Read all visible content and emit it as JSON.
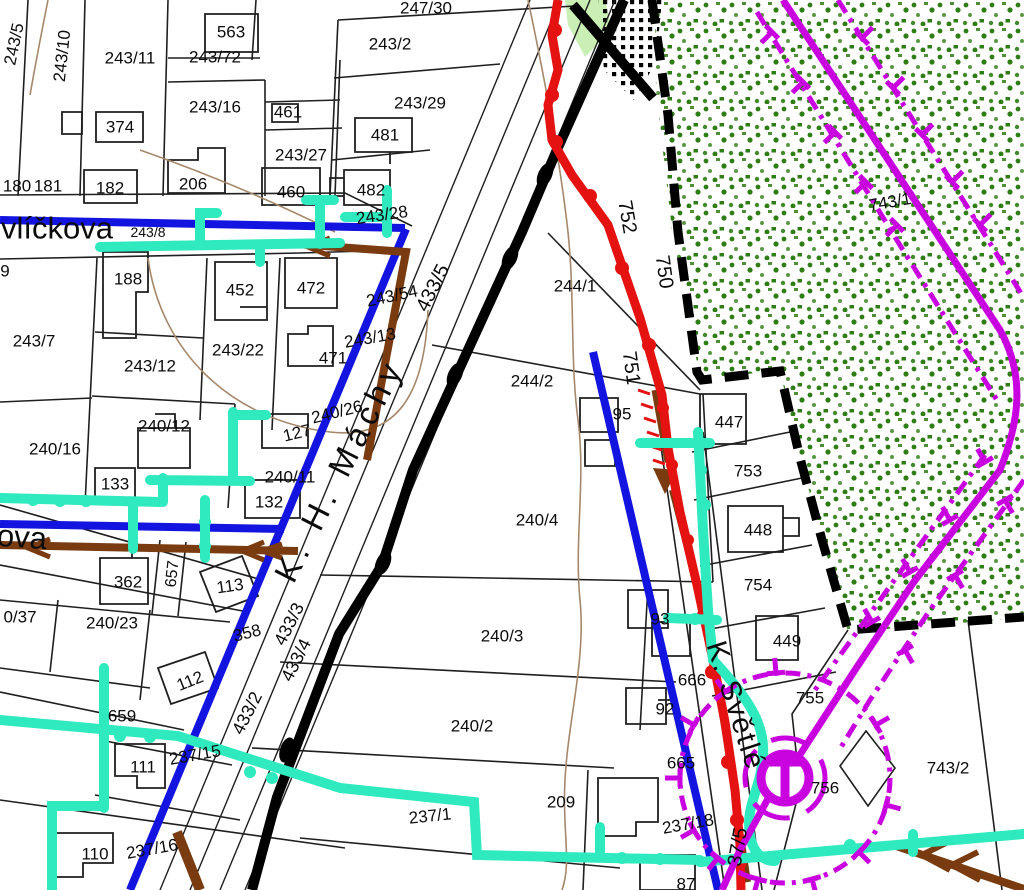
{
  "map": {
    "title": "cadastral-utility-map",
    "colors": {
      "line_blue": "#1414e0",
      "line_cyan": "#2fe9bf",
      "line_brown": "#7a3b10",
      "line_red": "#e51212",
      "line_magenta": "#c803e0",
      "line_black": "#000000",
      "parcel_line": "#1f1f1f",
      "contour_light_brown": "#a5886a",
      "forest_dot_green": "#2f7d15",
      "strip_light_green": "#c9efb5",
      "label_color": "#0c0c0c"
    },
    "street_names": [
      {
        "t": "vlíčkova",
        "x": 57,
        "y": 228,
        "r": 0,
        "s": 31
      },
      {
        "t": "ova",
        "x": 22,
        "y": 537,
        "r": 4,
        "s": 31
      },
      {
        "t": "K. H. Máchy",
        "x": 339,
        "y": 470,
        "r": -63,
        "s": 33,
        "ls": 6
      },
      {
        "t": "K. Světlé",
        "x": 735,
        "y": 706,
        "r": 72,
        "s": 29,
        "ls": 2
      }
    ],
    "labels": [
      {
        "t": "243/5",
        "x": 14,
        "y": 44,
        "r": -78
      },
      {
        "t": "243/10",
        "x": 62,
        "y": 56,
        "r": -84
      },
      {
        "t": "243/11",
        "x": 130,
        "y": 58
      },
      {
        "t": "563",
        "x": 231,
        "y": 32
      },
      {
        "t": "243/72",
        "x": 215,
        "y": 57
      },
      {
        "t": "243/16",
        "x": 215,
        "y": 107
      },
      {
        "t": "374",
        "x": 120,
        "y": 127
      },
      {
        "t": "461",
        "x": 288,
        "y": 112
      },
      {
        "t": "243/27",
        "x": 301,
        "y": 155
      },
      {
        "t": "180",
        "x": 17,
        "y": 186
      },
      {
        "t": "181",
        "x": 48,
        "y": 186
      },
      {
        "t": "182",
        "x": 110,
        "y": 188
      },
      {
        "t": "206",
        "x": 193,
        "y": 184
      },
      {
        "t": "460",
        "x": 291,
        "y": 192
      },
      {
        "t": "243/8",
        "x": 148,
        "y": 232,
        "s": 14
      },
      {
        "t": "243/2",
        "x": 390,
        "y": 44
      },
      {
        "t": "247/30",
        "x": 426,
        "y": 8
      },
      {
        "t": "243/29",
        "x": 420,
        "y": 103
      },
      {
        "t": "481",
        "x": 385,
        "y": 135
      },
      {
        "t": "482",
        "x": 371,
        "y": 190
      },
      {
        "t": "243/28",
        "x": 382,
        "y": 215,
        "r": -8
      },
      {
        "t": "188",
        "x": 128,
        "y": 279
      },
      {
        "t": "452",
        "x": 240,
        "y": 290
      },
      {
        "t": "472",
        "x": 311,
        "y": 288
      },
      {
        "t": "243/54",
        "x": 392,
        "y": 296,
        "r": -12
      },
      {
        "t": "243/7",
        "x": 34,
        "y": 341
      },
      {
        "t": "243/22",
        "x": 238,
        "y": 350
      },
      {
        "t": "243/13",
        "x": 370,
        "y": 338,
        "r": -10
      },
      {
        "t": "471",
        "x": 333,
        "y": 358
      },
      {
        "t": "243/12",
        "x": 150,
        "y": 366
      },
      {
        "t": "244/1",
        "x": 575,
        "y": 286
      },
      {
        "t": "244/2",
        "x": 532,
        "y": 381
      },
      {
        "t": "240/12",
        "x": 164,
        "y": 426
      },
      {
        "t": "127",
        "x": 297,
        "y": 433,
        "r": -14
      },
      {
        "t": "240/16",
        "x": 55,
        "y": 449
      },
      {
        "t": "240/26",
        "x": 337,
        "y": 412,
        "r": -14
      },
      {
        "t": "133",
        "x": 115,
        "y": 484
      },
      {
        "t": "240/11",
        "x": 290,
        "y": 477
      },
      {
        "t": "132",
        "x": 269,
        "y": 502
      },
      {
        "t": "433/5",
        "x": 433,
        "y": 288,
        "r": -63,
        "s": 20
      },
      {
        "t": "240/4",
        "x": 537,
        "y": 520
      },
      {
        "t": "95",
        "x": 622,
        "y": 414
      },
      {
        "t": "751",
        "x": 631,
        "y": 368,
        "r": 82,
        "s": 20
      },
      {
        "t": "750",
        "x": 664,
        "y": 272,
        "r": 82,
        "s": 20
      },
      {
        "t": "752",
        "x": 627,
        "y": 217,
        "r": 80,
        "s": 20
      },
      {
        "t": "743/1",
        "x": 890,
        "y": 202,
        "r": -10
      },
      {
        "t": "447",
        "x": 729,
        "y": 422
      },
      {
        "t": "753",
        "x": 748,
        "y": 471
      },
      {
        "t": "448",
        "x": 758,
        "y": 530
      },
      {
        "t": "754",
        "x": 758,
        "y": 585
      },
      {
        "t": "449",
        "x": 787,
        "y": 641
      },
      {
        "t": "362",
        "x": 128,
        "y": 582
      },
      {
        "t": "657",
        "x": 173,
        "y": 574,
        "r": -84,
        "s": 16
      },
      {
        "t": "113",
        "x": 230,
        "y": 586,
        "r": -8
      },
      {
        "t": "0/37",
        "x": 20,
        "y": 617
      },
      {
        "t": "240/23",
        "x": 112,
        "y": 623
      },
      {
        "t": "358",
        "x": 247,
        "y": 633,
        "r": -14
      },
      {
        "t": "433/3",
        "x": 289,
        "y": 624,
        "r": -63,
        "s": 18
      },
      {
        "t": "433/4",
        "x": 296,
        "y": 660,
        "r": -63,
        "s": 18
      },
      {
        "t": "433/2",
        "x": 247,
        "y": 713,
        "r": -63,
        "s": 18
      },
      {
        "t": "112",
        "x": 190,
        "y": 681,
        "r": -22
      },
      {
        "t": "659",
        "x": 122,
        "y": 716
      },
      {
        "t": "237/15",
        "x": 195,
        "y": 755,
        "r": -10
      },
      {
        "t": "111",
        "x": 143,
        "y": 767
      },
      {
        "t": "110",
        "x": 95,
        "y": 854
      },
      {
        "t": "237/16",
        "x": 152,
        "y": 849,
        "r": -10
      },
      {
        "t": "240/3",
        "x": 502,
        "y": 636
      },
      {
        "t": "240/2",
        "x": 472,
        "y": 726
      },
      {
        "t": "237/1",
        "x": 430,
        "y": 816,
        "r": -6
      },
      {
        "t": "209",
        "x": 561,
        "y": 802
      },
      {
        "t": "93",
        "x": 660,
        "y": 619
      },
      {
        "t": "92",
        "x": 665,
        "y": 709
      },
      {
        "t": "666",
        "x": 692,
        "y": 680
      },
      {
        "t": "665",
        "x": 681,
        "y": 763
      },
      {
        "t": "237/18",
        "x": 688,
        "y": 824,
        "r": -10
      },
      {
        "t": "87",
        "x": 686,
        "y": 884
      },
      {
        "t": "755",
        "x": 810,
        "y": 698
      },
      {
        "t": "756",
        "x": 825,
        "y": 788
      },
      {
        "t": "743/2",
        "x": 948,
        "y": 768
      },
      {
        "t": "37/5",
        "x": 738,
        "y": 847,
        "r": -80,
        "s": 20
      },
      {
        "t": "9",
        "x": 5,
        "y": 271
      }
    ]
  }
}
